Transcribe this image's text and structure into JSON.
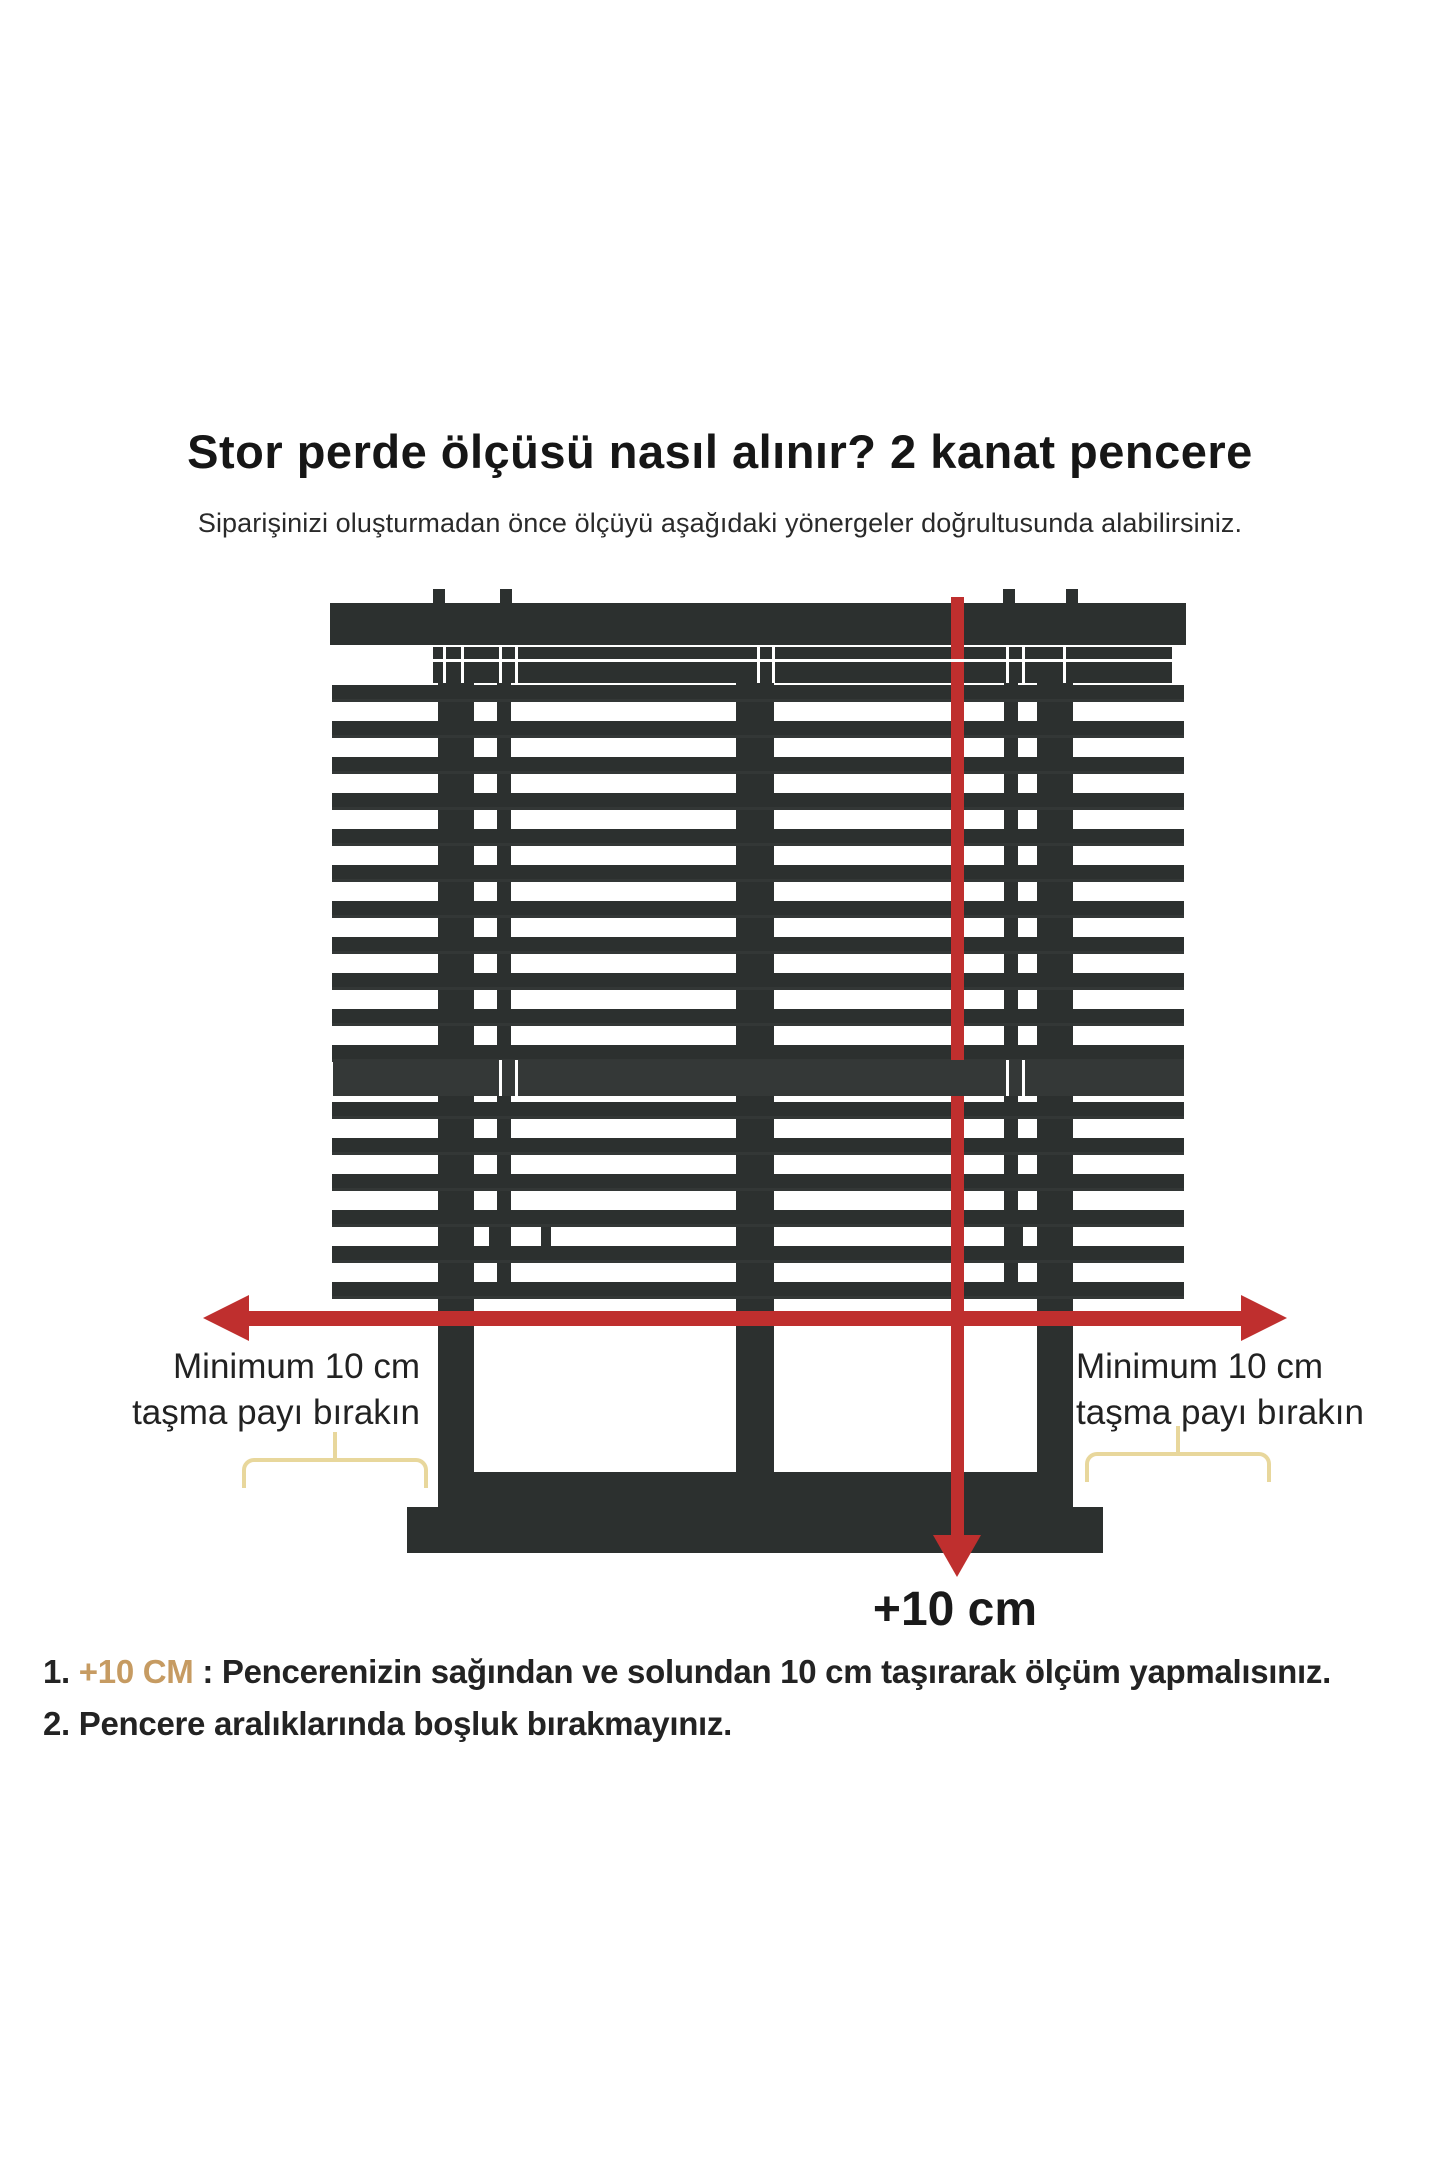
{
  "page": {
    "title": "Stor perde ölçüsü nasıl alınır? 2 kanat pencere",
    "subtitle": "Siparişinizi oluşturmadan önce ölçüyü aşağıdaki yönergeler doğrultusunda alabilirsiniz."
  },
  "diagram": {
    "labels": {
      "left_line1": "Minimum 10 cm",
      "left_line2": "taşma payı bırakın",
      "right_line1": "Minimum 10 cm",
      "right_line2": "taşma payı bırakın",
      "plus10_bottom": "+10 cm"
    },
    "colors": {
      "dark": "#2c302f",
      "rail": "#343837",
      "red": "#bf2f2e",
      "brace": "#e8d79c",
      "hairline": "#ffffff"
    },
    "rects": [
      {
        "name": "mount-tab",
        "x": 433,
        "y": 589,
        "w": 12,
        "h": 18
      },
      {
        "name": "mount-tab",
        "x": 500,
        "y": 589,
        "w": 12,
        "h": 18
      },
      {
        "name": "mount-tab",
        "x": 1003,
        "y": 589,
        "w": 12,
        "h": 18
      },
      {
        "name": "mount-tab",
        "x": 1066,
        "y": 589,
        "w": 12,
        "h": 18
      },
      {
        "name": "blind-header-rail",
        "x": 330,
        "y": 603,
        "w": 856,
        "h": 42
      },
      {
        "name": "window-top-band",
        "x": 433,
        "y": 647,
        "w": 739,
        "h": 36
      },
      {
        "name": "window-post-left",
        "x": 438,
        "y": 647,
        "w": 36,
        "h": 860
      },
      {
        "name": "window-post-center",
        "x": 736,
        "y": 647,
        "w": 38,
        "h": 860
      },
      {
        "name": "window-post-right",
        "x": 1037,
        "y": 647,
        "w": 36,
        "h": 860
      },
      {
        "name": "blind-cord-left",
        "x": 497,
        "y": 647,
        "w": 14,
        "h": 649
      },
      {
        "name": "blind-cord-right",
        "x": 1004,
        "y": 647,
        "w": 14,
        "h": 649
      },
      {
        "name": "window-bottom-rail",
        "x": 438,
        "y": 1472,
        "w": 635,
        "h": 35
      },
      {
        "name": "window-sill",
        "x": 407,
        "y": 1507,
        "w": 696,
        "h": 46
      }
    ],
    "slats": {
      "x": 332,
      "w": 852,
      "h": 14,
      "rows": [
        685,
        721,
        757,
        793,
        829,
        865,
        901,
        937,
        973,
        1009,
        1045,
        1102,
        1138,
        1174,
        1210,
        1246,
        1282
      ]
    },
    "mid_rail": {
      "x": 333,
      "y": 1060,
      "w": 851,
      "h": 36
    },
    "hairlines": [
      {
        "x": 433,
        "y": 659,
        "w": 739,
        "h": 3
      },
      {
        "x": 443,
        "y": 647,
        "w": 3,
        "h": 36
      },
      {
        "x": 461,
        "y": 647,
        "w": 3,
        "h": 36
      },
      {
        "x": 499,
        "y": 647,
        "w": 3,
        "h": 36
      },
      {
        "x": 515,
        "y": 647,
        "w": 3,
        "h": 36
      },
      {
        "x": 757,
        "y": 647,
        "w": 3,
        "h": 36
      },
      {
        "x": 772,
        "y": 647,
        "w": 3,
        "h": 36
      },
      {
        "x": 1006,
        "y": 647,
        "w": 3,
        "h": 36
      },
      {
        "x": 1022,
        "y": 647,
        "w": 3,
        "h": 36
      },
      {
        "x": 1063,
        "y": 647,
        "w": 3,
        "h": 36
      },
      {
        "x": 499,
        "y": 1060,
        "w": 3,
        "h": 36
      },
      {
        "x": 515,
        "y": 1060,
        "w": 3,
        "h": 36
      },
      {
        "x": 1006,
        "y": 1060,
        "w": 3,
        "h": 36
      },
      {
        "x": 1022,
        "y": 1060,
        "w": 3,
        "h": 36
      }
    ],
    "handles": [
      {
        "x": 489,
        "y": 1222,
        "w": 10,
        "h": 32
      },
      {
        "x": 541,
        "y": 1222,
        "w": 10,
        "h": 32
      },
      {
        "x": 1014,
        "y": 1222,
        "w": 9,
        "h": 32
      }
    ],
    "arrow_h": {
      "x1": 203,
      "x2": 1287,
      "cy": 1318,
      "thickness": 15,
      "head_len": 46,
      "head_half": 23
    },
    "arrow_v": {
      "cx": 957,
      "y1": 597,
      "y2": 1577,
      "thickness": 13,
      "head_len": 42,
      "head_half": 24
    },
    "braces": [
      {
        "x": 242,
        "y": 1458,
        "w": 178,
        "h": 26
      },
      {
        "x": 1085,
        "y": 1452,
        "w": 178,
        "h": 26
      }
    ]
  },
  "notes": {
    "item1_number": "1. ",
    "item1_highlight": "+10 CM",
    "item1_rest": " : Pencerenizin sağından ve solundan 10 cm taşırarak ölçüm yapmalısınız.",
    "item2_text": "2. Pencere aralıklarında boşluk bırakmayınız."
  }
}
